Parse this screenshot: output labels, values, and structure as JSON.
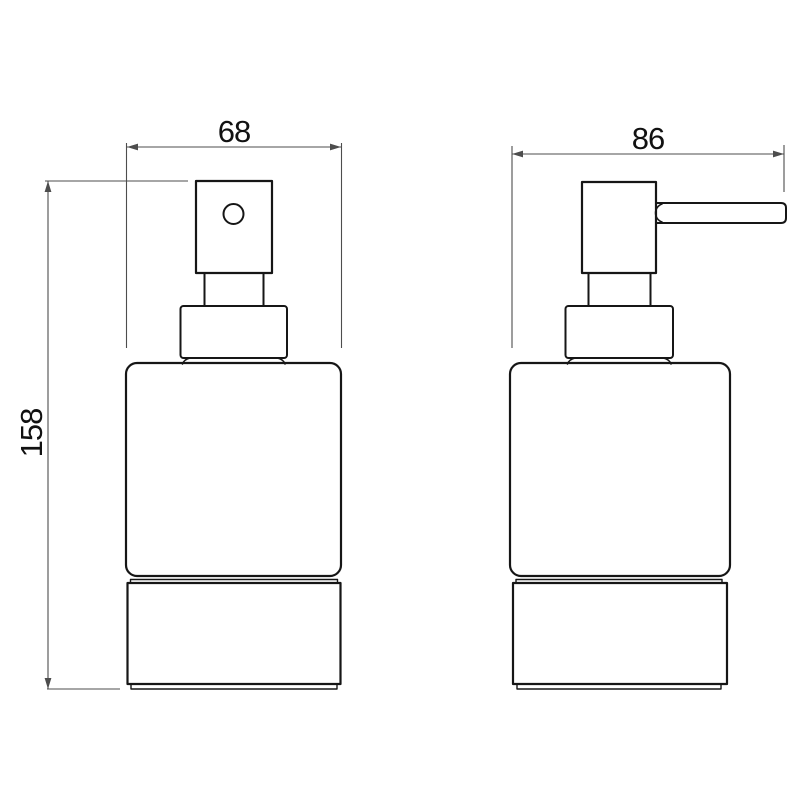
{
  "drawing": {
    "kind": "technical-dimension-drawing",
    "subject": "soap-dispenser-two-views",
    "dimensions": {
      "front_width_mm": "68",
      "side_width_mm": "86",
      "height_mm": "158"
    },
    "colors": {
      "background": "#ffffff",
      "outline": "#161616",
      "dimension": "#4d4d4d",
      "text": "#111111"
    }
  }
}
